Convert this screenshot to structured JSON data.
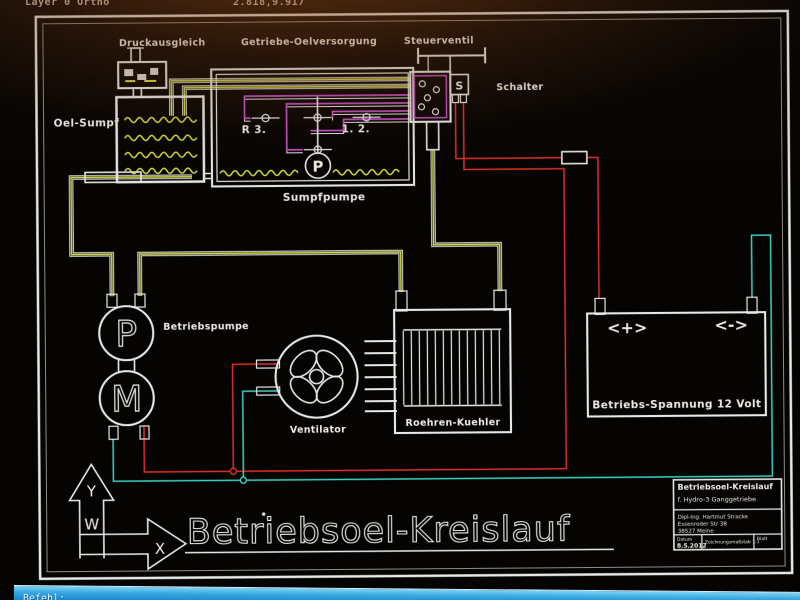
{
  "status_bar": {
    "left_text": "Layer 0 Ortho",
    "coords": "2.818,9.917"
  },
  "command_bar": {
    "prompt": "Befehl:"
  },
  "diagram": {
    "labels": {
      "druckausgleich": "Druckausgleich",
      "getriebe_oelversorgung": "Getriebe-Oelversorgung",
      "steuerventil": "Steuerventil",
      "schalter": "Schalter",
      "oel_sumpf": "Oel-Sumpf",
      "sumpfpumpe": "Sumpfpumpe",
      "betriebspumpe": "Betriebspumpe",
      "ventilator": "Ventilator",
      "roehren_kuehler": "Roehren-Kuehler",
      "valve_r3": "R 3.",
      "valve_12": "1. 2.",
      "switch_s": "S",
      "pump_p": "P",
      "motor_m": "M",
      "sumpfpumpe_p": "P",
      "battery_plus": "<+>",
      "battery_minus": "<->",
      "battery_caption": "Betriebs-Spannung 12 Volt",
      "axis_y": "Y",
      "axis_w": "W",
      "axis_x": "X",
      "main_title": "Betriebsoel-Kreislauf"
    },
    "title_block": {
      "title": "Betriebsoel-Kreislauf",
      "subtitle": "f. Hydro-3 Ganggetriebe",
      "author": "Dipl-Ing. Hartmut Stracke",
      "street": "Essenroder Str 38",
      "city": "38527 Meine",
      "date_label": "Datum",
      "date_value": "8.5.2012",
      "scale": "Zeichnungsmaßstab 1:1",
      "sheet_label": "Blatt"
    },
    "colors": {
      "oil-yellow": "#d6df3f",
      "hydraulic-magenta": "#c44ec4",
      "wire-red": "#e03028",
      "wire-cyan": "#3ad2c2",
      "line-white": "#e8e8e6",
      "command-blue": "#2f9fd8"
    }
  }
}
